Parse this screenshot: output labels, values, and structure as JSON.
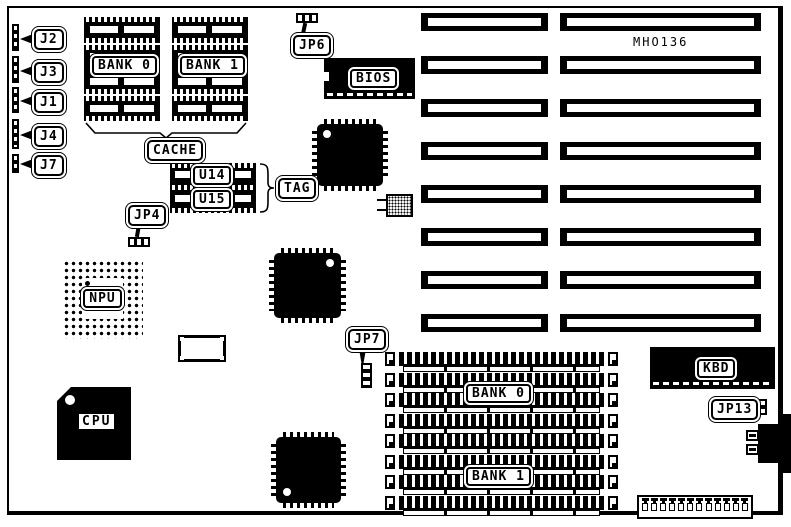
{
  "board": {
    "model": "MHO136"
  },
  "left_jumpers": {
    "j2": "J2",
    "j3": "J3",
    "j1": "J1",
    "j4": "J4",
    "j7": "J7"
  },
  "jumpers": {
    "jp4": "JP4",
    "jp6": "JP6",
    "jp7": "JP7",
    "jp13": "JP13"
  },
  "cache": {
    "bank0": "BANK 0",
    "bank1": "BANK 1",
    "label": "CACHE",
    "u14": "U14",
    "u15": "U15",
    "tag": "TAG"
  },
  "chips": {
    "bios": "BIOS",
    "npu": "NPU",
    "cpu": "CPU",
    "kbd": "KBD"
  },
  "memory": {
    "bank0": "BANK 0",
    "bank1": "BANK 1"
  }
}
